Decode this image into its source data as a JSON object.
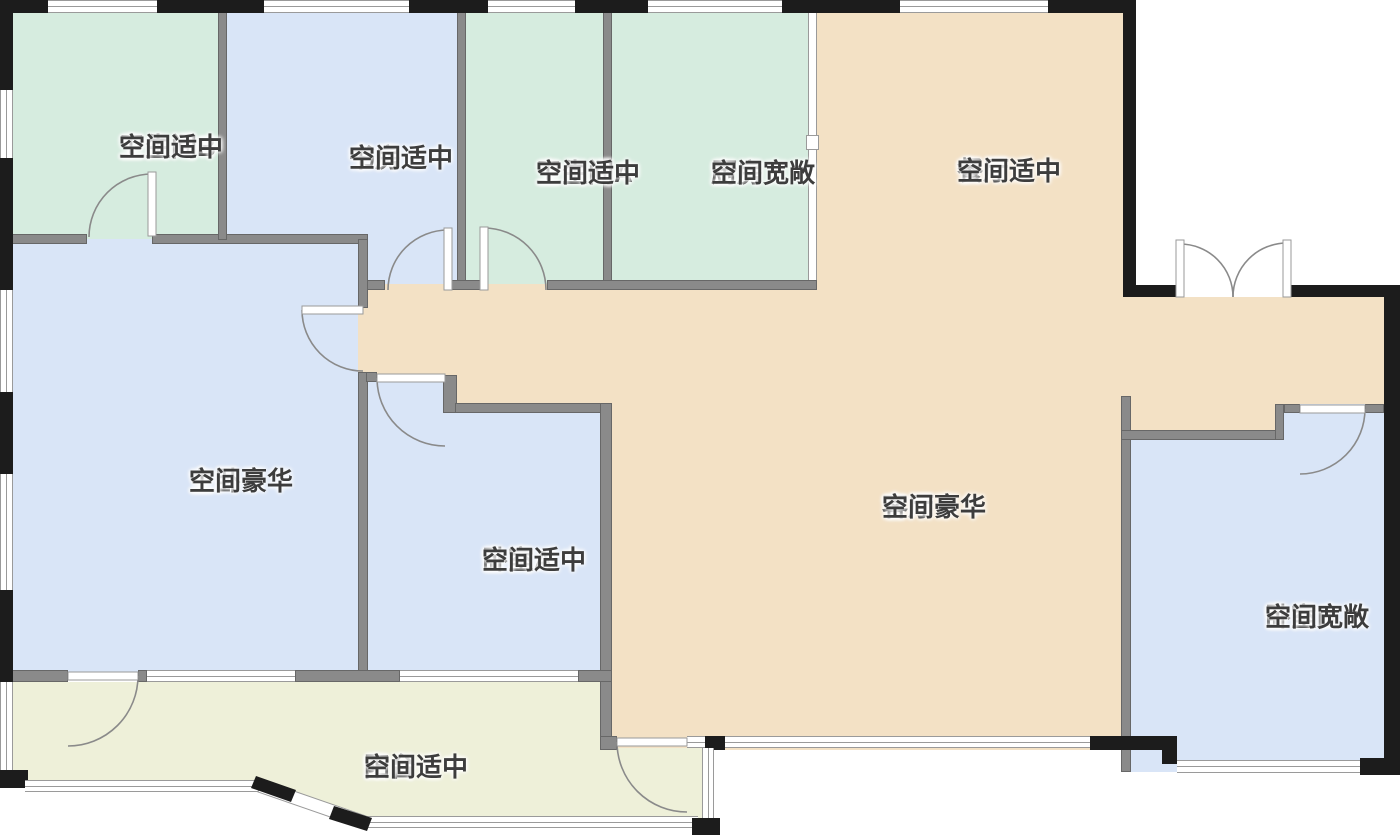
{
  "floorplan": {
    "type": "apartment-floor-plan",
    "rooms": [
      {
        "name": "卫生间B",
        "condition": "空间适中",
        "fill": "#d6ecdf"
      },
      {
        "name": "书房",
        "condition": "空间适中",
        "fill": "#d9e5f7"
      },
      {
        "name": "卫生间A",
        "condition": "空间适中",
        "fill": "#d6ecdf"
      },
      {
        "name": "厨房",
        "condition": "空间宽敞",
        "fill": "#d6ecdf"
      },
      {
        "name": "餐厅",
        "condition": "空间适中",
        "fill": "#f3e1c5"
      },
      {
        "name": "主卧",
        "condition": "空间豪华",
        "fill": "#d9e5f7"
      },
      {
        "name": "卧室A",
        "condition": "空间适中",
        "fill": "#d9e5f7"
      },
      {
        "name": "客厅",
        "condition": "空间豪华",
        "fill": "#f3e1c5"
      },
      {
        "name": "卧室B",
        "condition": "空间宽敞",
        "fill": "#d9e5f7"
      },
      {
        "name": "阳台",
        "condition": "空间适中",
        "fill": "#eef0d9"
      }
    ],
    "palette": {
      "bathroom_kitchen_green": "#d6ecdf",
      "bedroom_study_blue": "#d9e5f7",
      "living_dining_tan": "#f3e1c5",
      "balcony_cream": "#eef0d9",
      "interior_wall_gray": "#8a8a8a",
      "exterior_wall_black": "#1c1c1c",
      "window_line_gray": "#9a9a9a",
      "label_text": "#3d3d3d",
      "background": "#ffffff"
    }
  }
}
